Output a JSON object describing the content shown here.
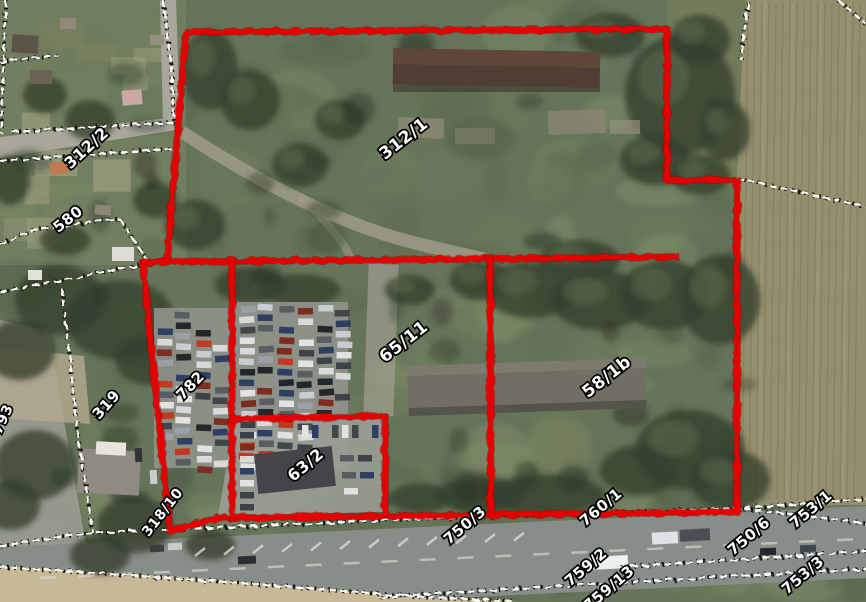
{
  "map": {
    "kind": "aerial-cadastral-map",
    "highlighted_parcel_ids": [
      "312/1",
      "65/11",
      "58/1b",
      "63/2",
      "782"
    ]
  },
  "colors": {
    "boundary_red": "#e60000",
    "cadastral_line_white": "#fbfbf8",
    "cadastral_line_black": "#161616",
    "label_fill": "#ffffff",
    "label_outline": "#000000"
  },
  "parcel_labels": [
    {
      "text": "312/2",
      "x": 90,
      "y": 152,
      "rot": -42,
      "size": 16
    },
    {
      "text": "580",
      "x": 71,
      "y": 223,
      "rot": -38,
      "size": 15
    },
    {
      "text": "312/1",
      "x": 407,
      "y": 143,
      "rot": -38,
      "size": 17
    },
    {
      "text": "65/11",
      "x": 407,
      "y": 346,
      "rot": -38,
      "size": 17
    },
    {
      "text": "58/1b",
      "x": 610,
      "y": 381,
      "rot": -38,
      "size": 17
    },
    {
      "text": "319",
      "x": 110,
      "y": 408,
      "rot": -48,
      "size": 15
    },
    {
      "text": "782",
      "x": 194,
      "y": 389,
      "rot": -46,
      "size": 15
    },
    {
      "text": "63/2",
      "x": 309,
      "y": 469,
      "rot": -40,
      "size": 16
    },
    {
      "text": "318/10",
      "x": 166,
      "y": 515,
      "rot": -52,
      "size": 14
    },
    {
      "text": "793",
      "x": 7,
      "y": 421,
      "rot": -66,
      "size": 14
    },
    {
      "text": "750/3",
      "x": 468,
      "y": 529,
      "rot": -40,
      "size": 15
    },
    {
      "text": "760/1",
      "x": 604,
      "y": 511,
      "rot": -40,
      "size": 15
    },
    {
      "text": "750/6",
      "x": 752,
      "y": 540,
      "rot": -40,
      "size": 15
    },
    {
      "text": "753/1",
      "x": 814,
      "y": 513,
      "rot": -40,
      "size": 15
    },
    {
      "text": "759/2",
      "x": 589,
      "y": 571,
      "rot": -40,
      "size": 15
    },
    {
      "text": "759/13",
      "x": 612,
      "y": 592,
      "rot": -40,
      "size": 15
    },
    {
      "text": "753/3",
      "x": 806,
      "y": 579,
      "rot": -40,
      "size": 15
    }
  ]
}
